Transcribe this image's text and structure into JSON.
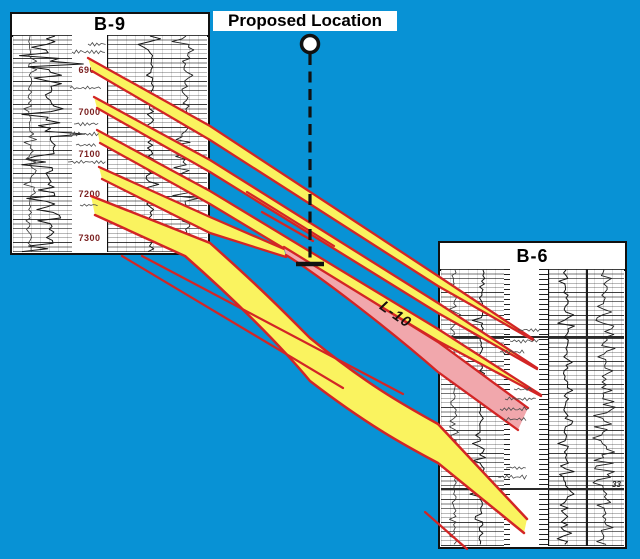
{
  "colors": {
    "bg": "#0892D5",
    "red": "#D32525",
    "yellow": "#FAF35F",
    "pink": "#F1A7AC",
    "ink": "#111111",
    "depth_text": "#7A1F1F"
  },
  "proposed_location": {
    "label": "Proposed Location"
  },
  "wells": {
    "b9": {
      "title": "B-9",
      "depth_labels": [
        "6900",
        "7000",
        "7100",
        "7200",
        "7300"
      ]
    },
    "b6": {
      "title": "B-6",
      "edge_annotation": "33"
    }
  },
  "correlation": {
    "l10_label": "L-10"
  }
}
